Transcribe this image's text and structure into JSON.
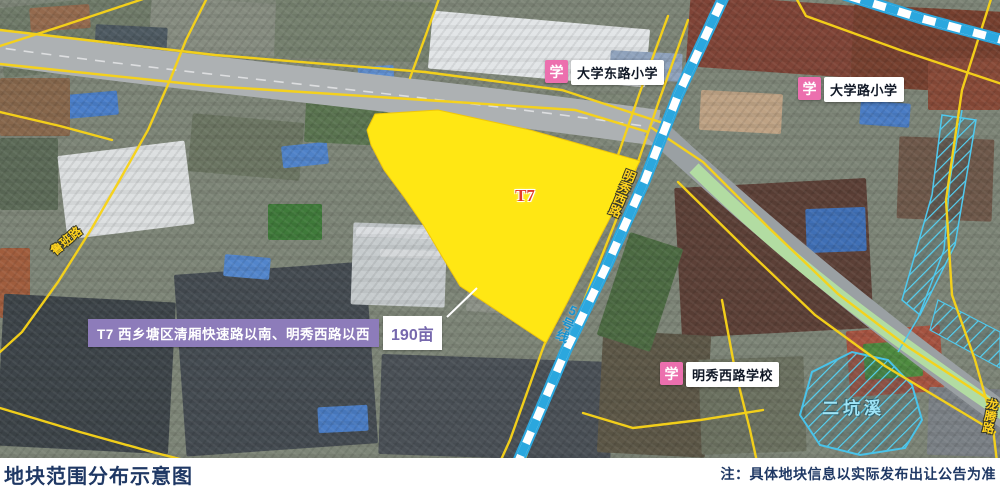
{
  "map": {
    "parcel": {
      "id": "T7",
      "label": "T7 西乡塘区清厢快速路以南、明秀西路以西",
      "area": "190亩"
    },
    "schools": [
      {
        "icon": "学",
        "name": "大学东路小学"
      },
      {
        "icon": "学",
        "name": "大学路小学"
      },
      {
        "icon": "学",
        "name": "明秀西路学校"
      }
    ],
    "roads": {
      "luban": "鲁班路",
      "mingxiu_west": "明秀西路",
      "longteng": "龙腾路"
    },
    "metro": {
      "line": "5号线"
    },
    "water": {
      "stream": "二坑溪"
    }
  },
  "footer": {
    "title": "地块范围分布示意图",
    "note": "注：具体地块信息以实际发布出让公告为准"
  },
  "colors": {
    "parcel_fill": "#ffe714",
    "road_line": "#f7d319",
    "metro_blue": "#2ba7de",
    "info_purple": "#8d7cba",
    "school_pink": "#ec6fae",
    "caption_navy": "#1f3864",
    "water_cyan": "#9fe4f6"
  }
}
